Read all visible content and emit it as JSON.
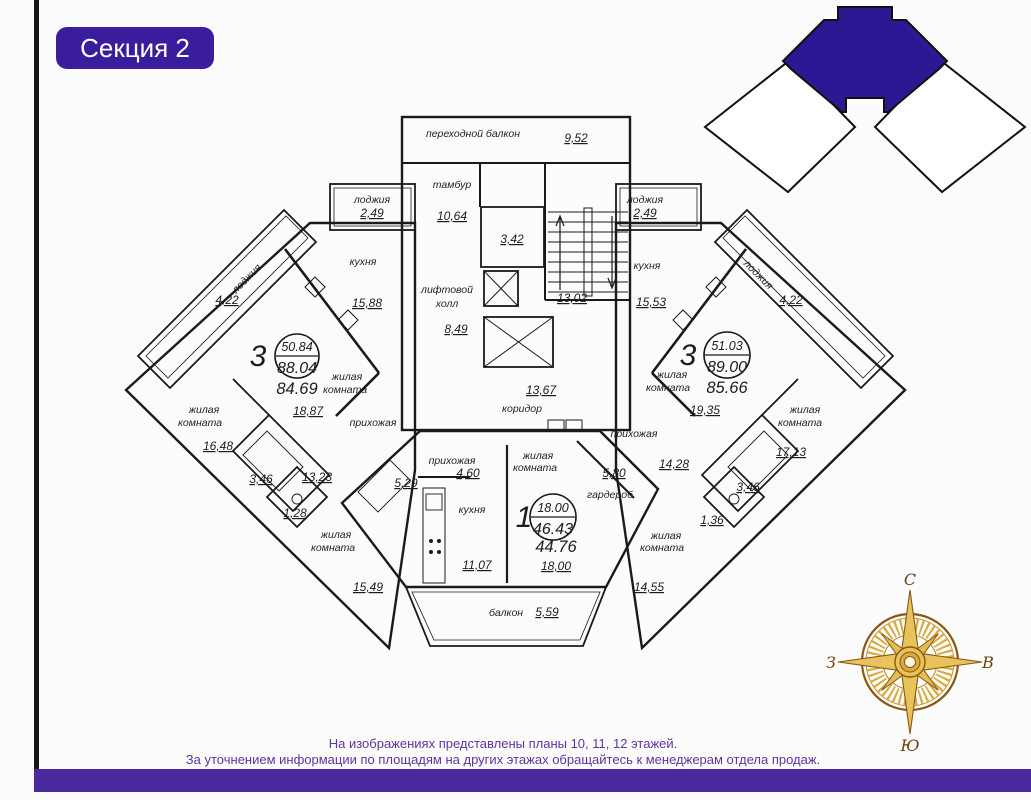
{
  "badge": {
    "label": "Секция 2"
  },
  "footer": {
    "line1": "На изображениях представлены планы 10, 11, 12 этажей.",
    "line2": "За уточнением информации по площадям на других этажах обращайтесь к менеджерам отдела продаж."
  },
  "compass": {
    "n": "С",
    "s": "Ю",
    "w": "З",
    "e": "В"
  },
  "core": {
    "transition_balcony": {
      "label": "переходной балкон",
      "area": "9,52"
    },
    "tambour": {
      "label": "тамбур",
      "area": "10,64"
    },
    "utility": {
      "area": "3,42"
    },
    "elevator_hall": {
      "l1": "лифтовой",
      "l2": "холл",
      "area": "8,49"
    },
    "staircase": {
      "area": "13,02"
    },
    "corridor": {
      "label": "коридор",
      "area": "13,67"
    }
  },
  "apartments": {
    "left": {
      "rooms_count": "3",
      "living_area": "50.84",
      "total_area": "88.04",
      "reduced_area": "84.69",
      "kitchen": {
        "label": "кухня",
        "area": "15,88"
      },
      "living1": {
        "l1": "жилая",
        "l2": "комната",
        "area": "18,87"
      },
      "living2": {
        "l1": "жилая",
        "l2": "комната",
        "area": "16,48"
      },
      "living3": {
        "l1": "жилая",
        "l2": "комната",
        "area": "15,49"
      },
      "hall": {
        "label": "прихожая",
        "area": "13,23"
      },
      "bath": {
        "area": "3,46"
      },
      "wc": {
        "area": "1,28"
      },
      "loggia_top": {
        "label": "лоджия",
        "area": "2,49"
      },
      "loggia_side": {
        "label": "лоджия",
        "area": "4,22"
      }
    },
    "center": {
      "rooms_count": "1",
      "living_area": "18.00",
      "total_area": "46.43",
      "reduced_area": "44.76",
      "hall": {
        "label": "прихожая",
        "area": "4,60"
      },
      "bath": {
        "area": "5,29"
      },
      "kitchen": {
        "label": "кухня",
        "area": "11,07"
      },
      "living": {
        "l1": "жилая",
        "l2": "комната",
        "area": "18,00"
      },
      "wardrobe": {
        "label": "гардероб",
        "area": "5,80"
      },
      "balcony": {
        "label": "балкон",
        "area": "5,59"
      }
    },
    "right": {
      "rooms_count": "3",
      "living_area": "51.03",
      "total_area": "89.00",
      "reduced_area": "85.66",
      "kitchen": {
        "label": "кухня",
        "area": "15,53"
      },
      "living1": {
        "l1": "жилая",
        "l2": "комната",
        "area": "19,35"
      },
      "living2": {
        "l1": "жилая",
        "l2": "комната",
        "area": "17,13"
      },
      "living3": {
        "l1": "жилая",
        "l2": "комната",
        "area": "14,55"
      },
      "hall": {
        "label": "прихожая",
        "area": "14,28"
      },
      "bath": {
        "area": "3,46"
      },
      "wc": {
        "area": "1,36"
      },
      "loggia_top": {
        "label": "лоджия",
        "area": "2,49"
      },
      "loggia_side": {
        "label": "лоджия",
        "area": "4,22"
      }
    }
  },
  "colors": {
    "accent_purple": "#3a1d9c",
    "keyplan_purple": "#2d1894",
    "bottom_bar": "#4a2a9c",
    "apartment_left": "#d7d2ed",
    "apartment_center": "#edf0c7",
    "apartment_right": "#f6d7b3",
    "footer_text": "#5d35a2",
    "compass_gold": "#d4a435"
  }
}
